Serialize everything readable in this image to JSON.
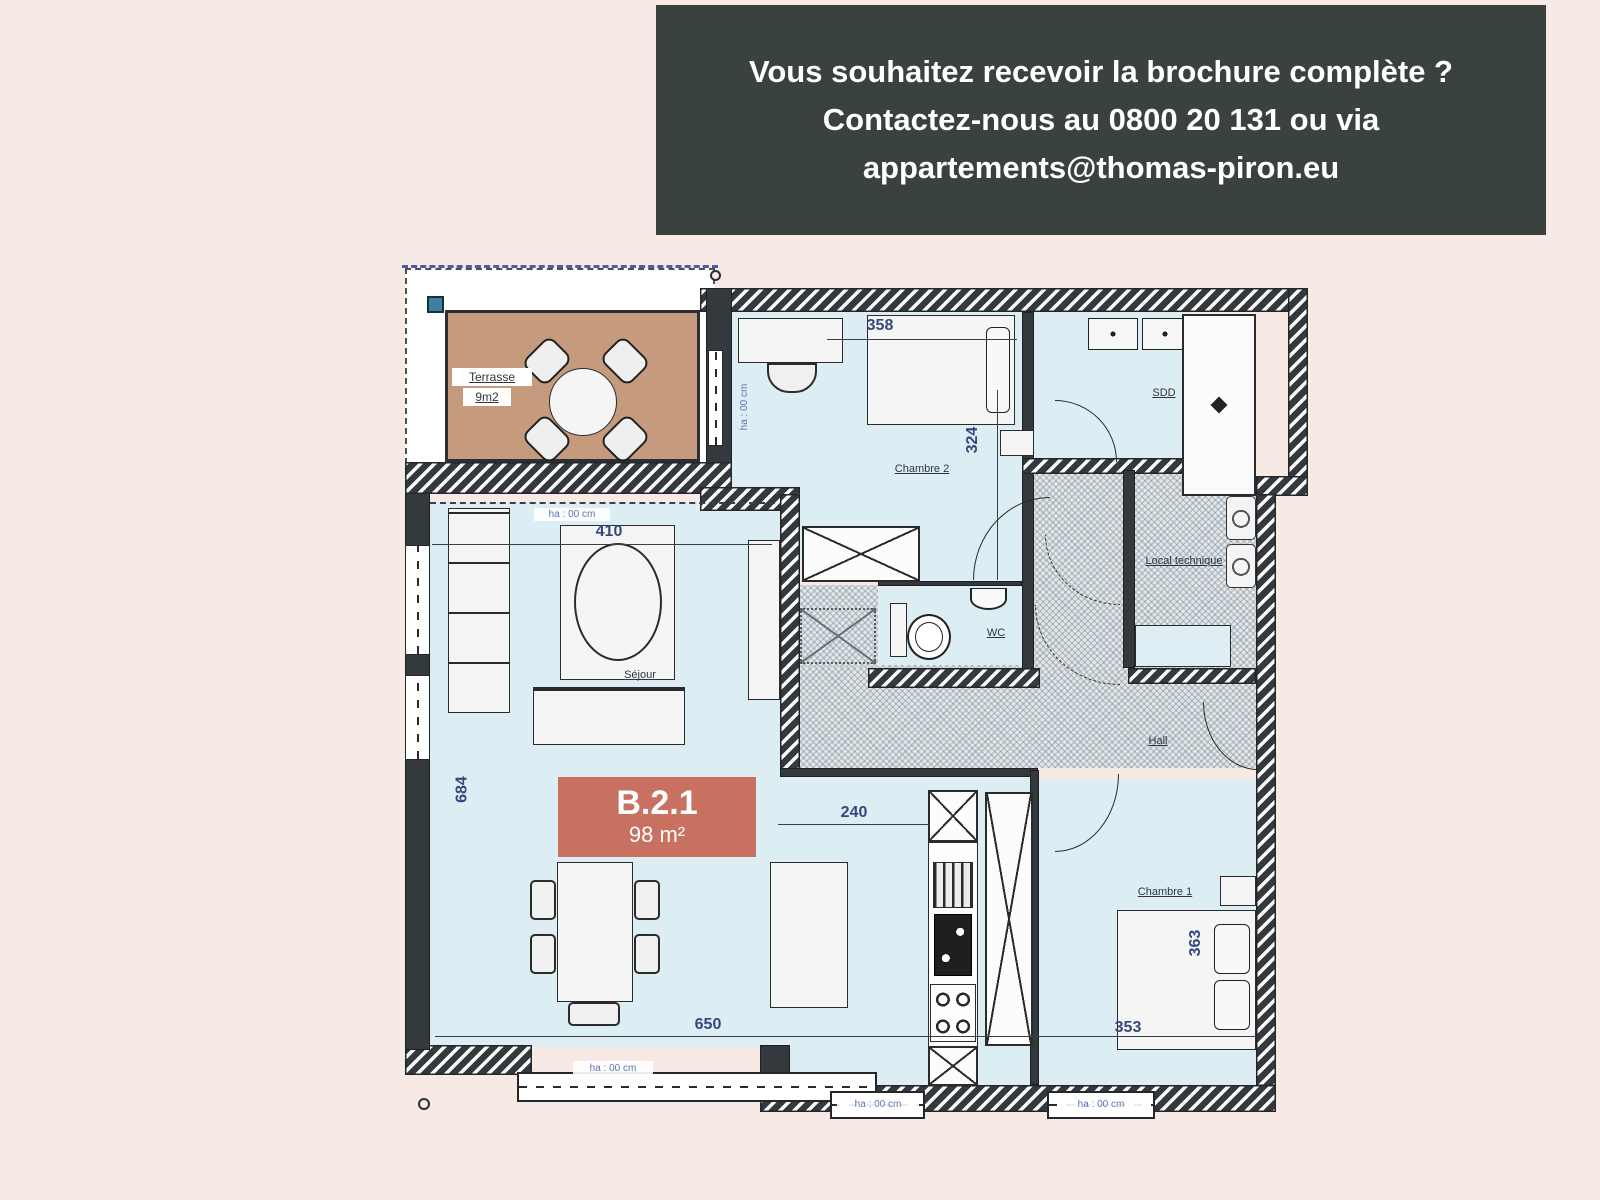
{
  "banner": {
    "lines": [
      "Vous souhaitez recevoir la brochure complète ?",
      "Contactez-nous au 0800 20 131 ou via",
      "appartements@thomas-piron.eu"
    ]
  },
  "unit": {
    "id": "B.2.1",
    "area": "98 m²"
  },
  "rooms": {
    "terrasse": "Terrasse",
    "terrasse_area": "9m2",
    "chambre2": "Chambre 2",
    "sdd": "SDD",
    "wc": "WC",
    "local_technique": "Local technique",
    "hall": "Hall",
    "sejour": "Séjour",
    "chambre1": "Chambre 1"
  },
  "dims": {
    "w358": "358",
    "w324": "324",
    "w410": "410",
    "w240": "240",
    "w650": "650",
    "w353": "353",
    "w363": "363",
    "w684": "684"
  },
  "annotations": {
    "sejour_top": "ha : 00 cm",
    "terrace_side": "ha : 00 cm",
    "bottom_left": "ha : 00 cm",
    "bottom_mid": "ha : 00 cm",
    "bottom_right": "ha : 00 cm"
  },
  "colors": {
    "background": "#f7e9e4",
    "banner_bg": "#3a423d",
    "floor": "#dcedf4",
    "terrace_floor": "#c69a7d",
    "unit_label_bg": "#c97160",
    "wall_dark": "#34393e",
    "dim_text": "#35487c"
  }
}
